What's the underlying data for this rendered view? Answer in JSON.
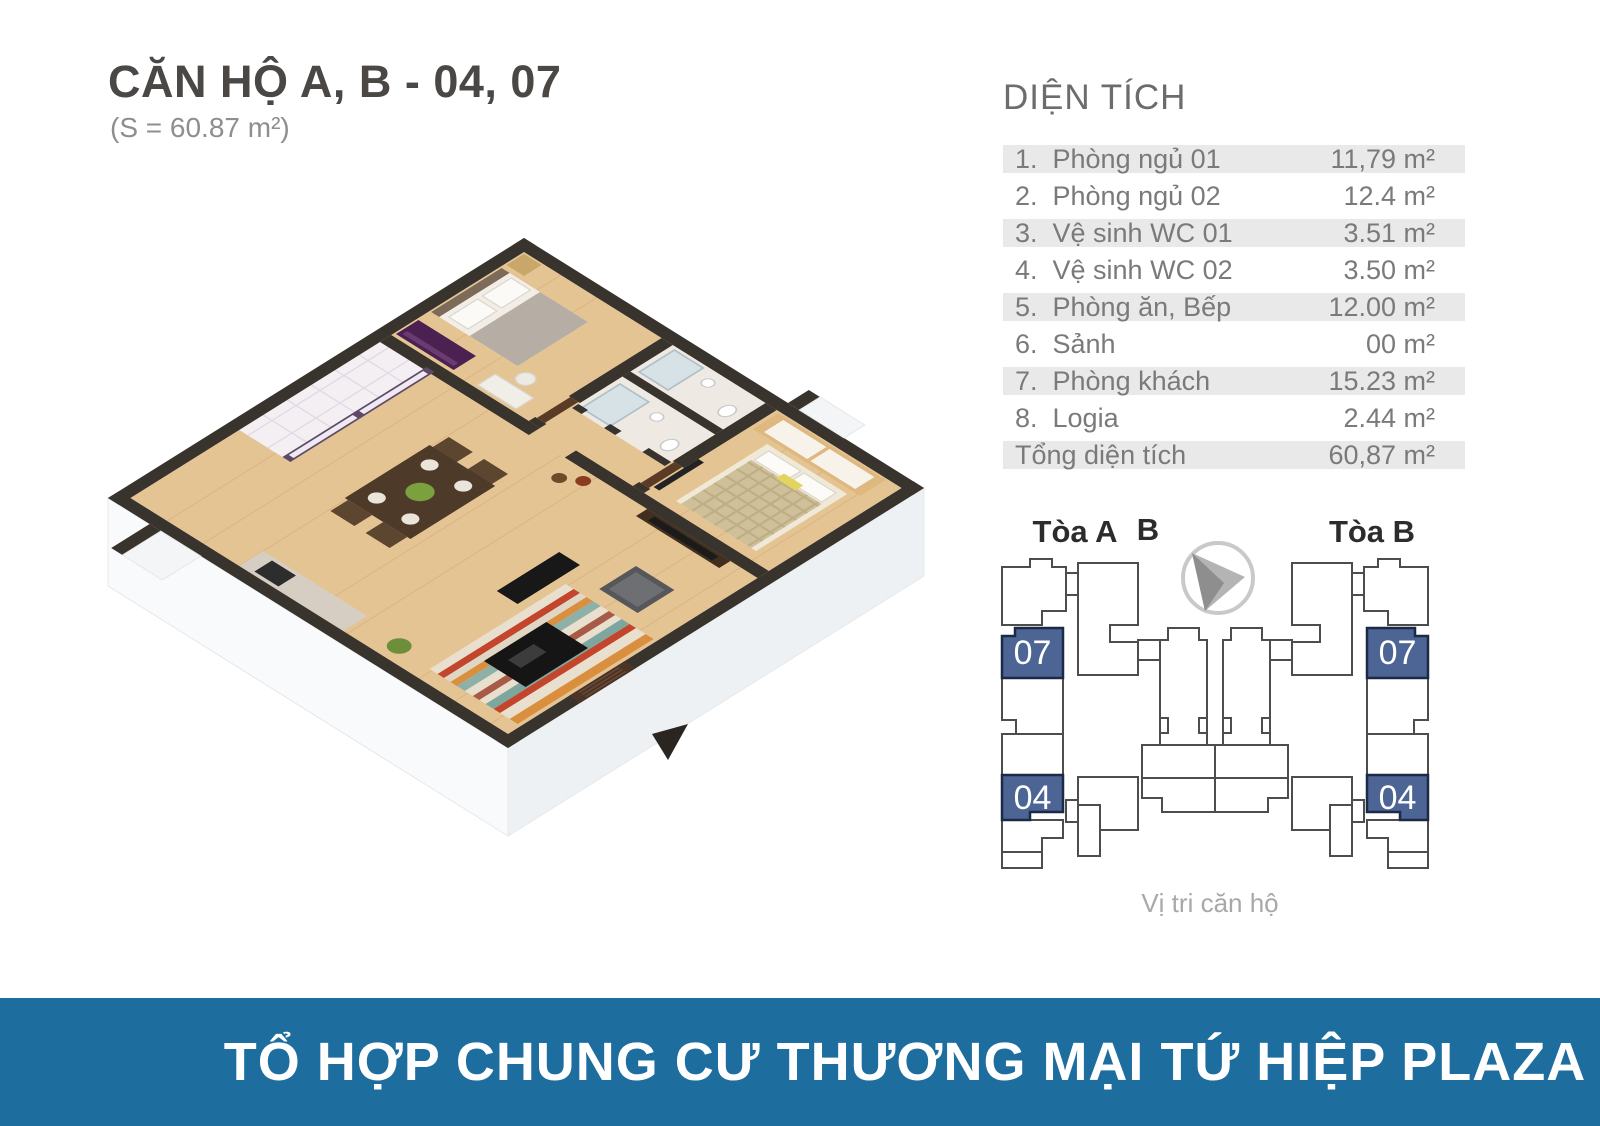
{
  "header": {
    "title": "CĂN HỘ A, B - 04, 07",
    "subtitle": "(S = 60.87 m²)"
  },
  "area_table": {
    "title": "DIỆN TÍCH",
    "rows": [
      {
        "label": "1.  Phòng ngủ 01",
        "value": "11,79 m²"
      },
      {
        "label": "2.  Phòng ngủ 02",
        "value": "12.4 m²"
      },
      {
        "label": "3.  Vệ sinh WC 01",
        "value": "3.51 m²"
      },
      {
        "label": "4.  Vệ sinh WC 02",
        "value": "3.50 m²"
      },
      {
        "label": "5.  Phòng ăn, Bếp",
        "value": "12.00 m²"
      },
      {
        "label": "6.  Sảnh",
        "value": "00 m²"
      },
      {
        "label": "7.  Phòng khách",
        "value": "15.23 m²"
      },
      {
        "label": "8.  Logia",
        "value": "2.44 m²"
      },
      {
        "label": "Tổng diện tích",
        "value": "60,87 m²"
      }
    ]
  },
  "diagram": {
    "tower_a_label": "Tòa A",
    "compass_label": "B",
    "tower_b_label": "Tòa B",
    "unit_top": "07",
    "unit_bottom": "04",
    "caption": "Vị tri căn hộ"
  },
  "footer": {
    "banner": "TỔ HỢP CHUNG CƯ THƯƠNG MẠI TỨ HIỆP PLAZA"
  },
  "colors": {
    "banner_blue": "#1d6d9f",
    "unit_blue": "#4d6594",
    "row_shade": "#e9e9e9",
    "wall_dark": "#38332c",
    "wood_floor": "#e5c494"
  }
}
